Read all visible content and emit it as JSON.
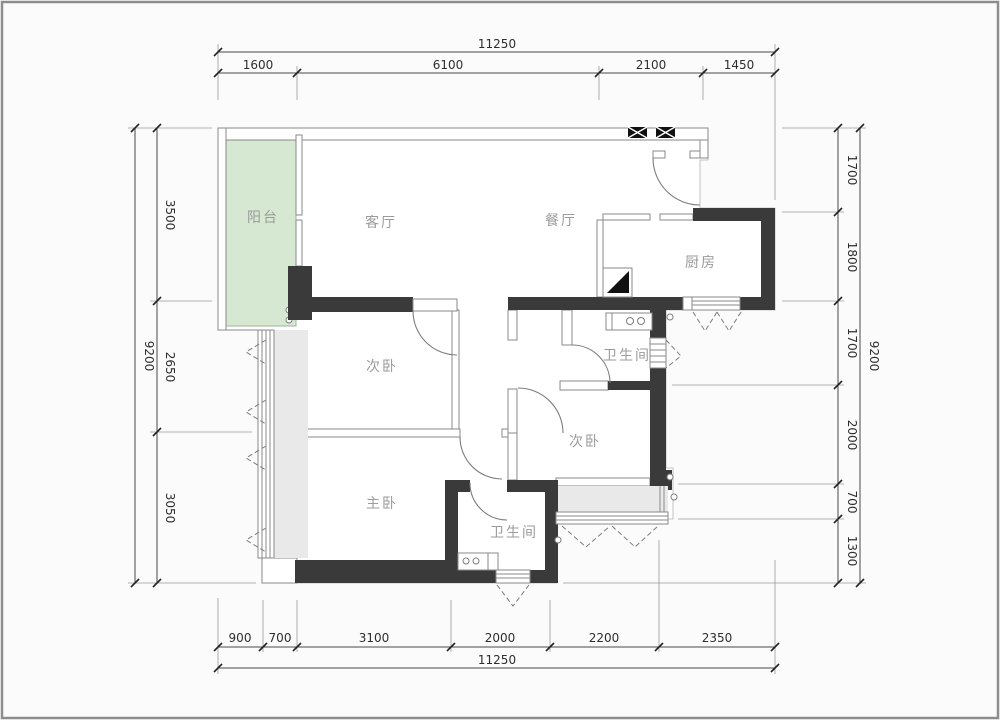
{
  "plan_title": "residential-floor-plan",
  "rooms": [
    {
      "name": "balcony",
      "label": "阳台"
    },
    {
      "name": "living-room",
      "label": "客厅"
    },
    {
      "name": "dining-room",
      "label": "餐厅"
    },
    {
      "name": "kitchen",
      "label": "厨房"
    },
    {
      "name": "bedroom-second-1",
      "label": "次卧"
    },
    {
      "name": "bathroom-1",
      "label": "卫生间"
    },
    {
      "name": "bedroom-second-2",
      "label": "次卧"
    },
    {
      "name": "master-bedroom",
      "label": "主卧"
    },
    {
      "name": "bathroom-2",
      "label": "卫生间"
    }
  ],
  "dimensions": {
    "top": {
      "overall": "11250",
      "segments": [
        "1600",
        "6100",
        "2100",
        "1450"
      ]
    },
    "bottom": {
      "overall": "11250",
      "segments": [
        "900",
        "700",
        "3100",
        "2000",
        "2200",
        "2350"
      ]
    },
    "left": {
      "overall": "9200",
      "segments": [
        "3500",
        "2650",
        "3050"
      ]
    },
    "right": {
      "overall": "9200",
      "segments": [
        "1700",
        "1800",
        "1700",
        "2000",
        "700",
        "1300"
      ]
    }
  },
  "colors": {
    "structural_wall": "#3a3a3a",
    "balcony_fill": "#d6e7d2",
    "bay_fill": "#e9e9e9",
    "line": "#8a8a8a",
    "dimension_text": "#2e2e2e",
    "room_text": "#9b9b9b"
  }
}
